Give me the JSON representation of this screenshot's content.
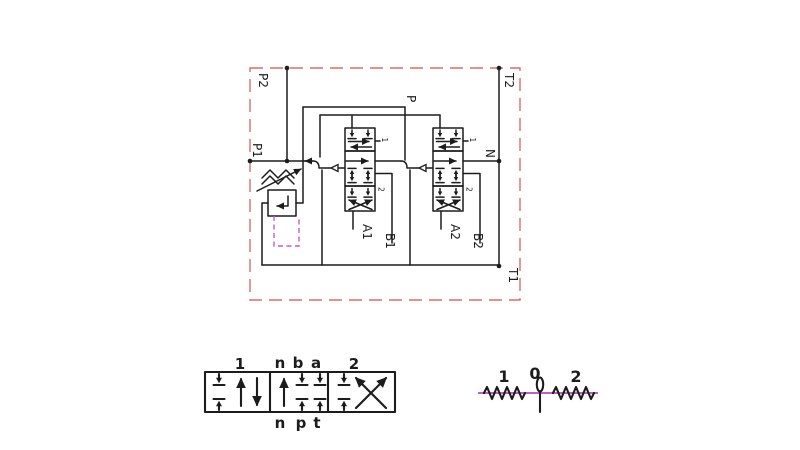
{
  "colors": {
    "line": "#1c1c1c",
    "boundary": "#d96c6c",
    "pilot": "#c45ec4"
  },
  "main_schematic": {
    "ports": {
      "p2": "P2",
      "t2": "T2",
      "p1": "P1",
      "n": "N",
      "t1": "T1",
      "p": "P",
      "a1": "A1",
      "b1": "B1",
      "a2": "A2",
      "b2": "B2"
    },
    "spool_positions": {
      "pos1": "1",
      "pos2": "2"
    }
  },
  "spool_detail": {
    "position_left": "1",
    "position_right": "2",
    "top_ports": [
      "n",
      "b",
      "a"
    ],
    "bottom_ports": [
      "n",
      "p",
      "t"
    ]
  },
  "actuator_detail": {
    "position_labels": [
      "1",
      "0",
      "2"
    ]
  }
}
